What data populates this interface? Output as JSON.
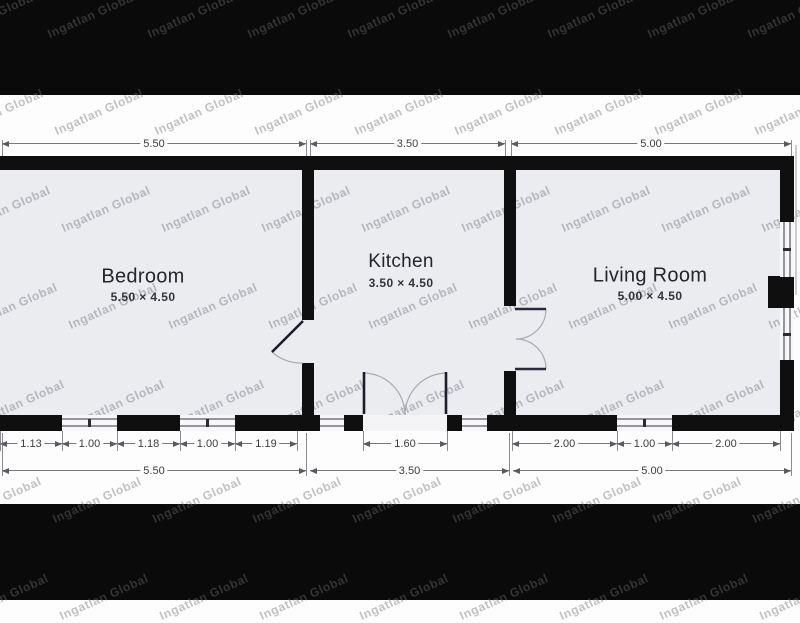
{
  "watermark": {
    "text": "Ingatlan Global"
  },
  "rooms": [
    {
      "id": "bedroom",
      "name": "Bedroom",
      "size": "5.50 × 4.50"
    },
    {
      "id": "kitchen",
      "name": "Kitchen",
      "size": "3.50 × 4.50"
    },
    {
      "id": "living-room",
      "name": "Living Room",
      "size": "5.00 × 4.50"
    }
  ],
  "dimensions": {
    "top": [
      "5.50",
      "3.50",
      "5.00"
    ],
    "bottom_detail": [
      "1.13",
      "1.00",
      "1.18",
      "1.00",
      "1.19",
      "1.60",
      "2.00",
      "1.00",
      "2.00"
    ],
    "bottom_overall": [
      "5.50",
      "3.50",
      "5.00"
    ]
  }
}
